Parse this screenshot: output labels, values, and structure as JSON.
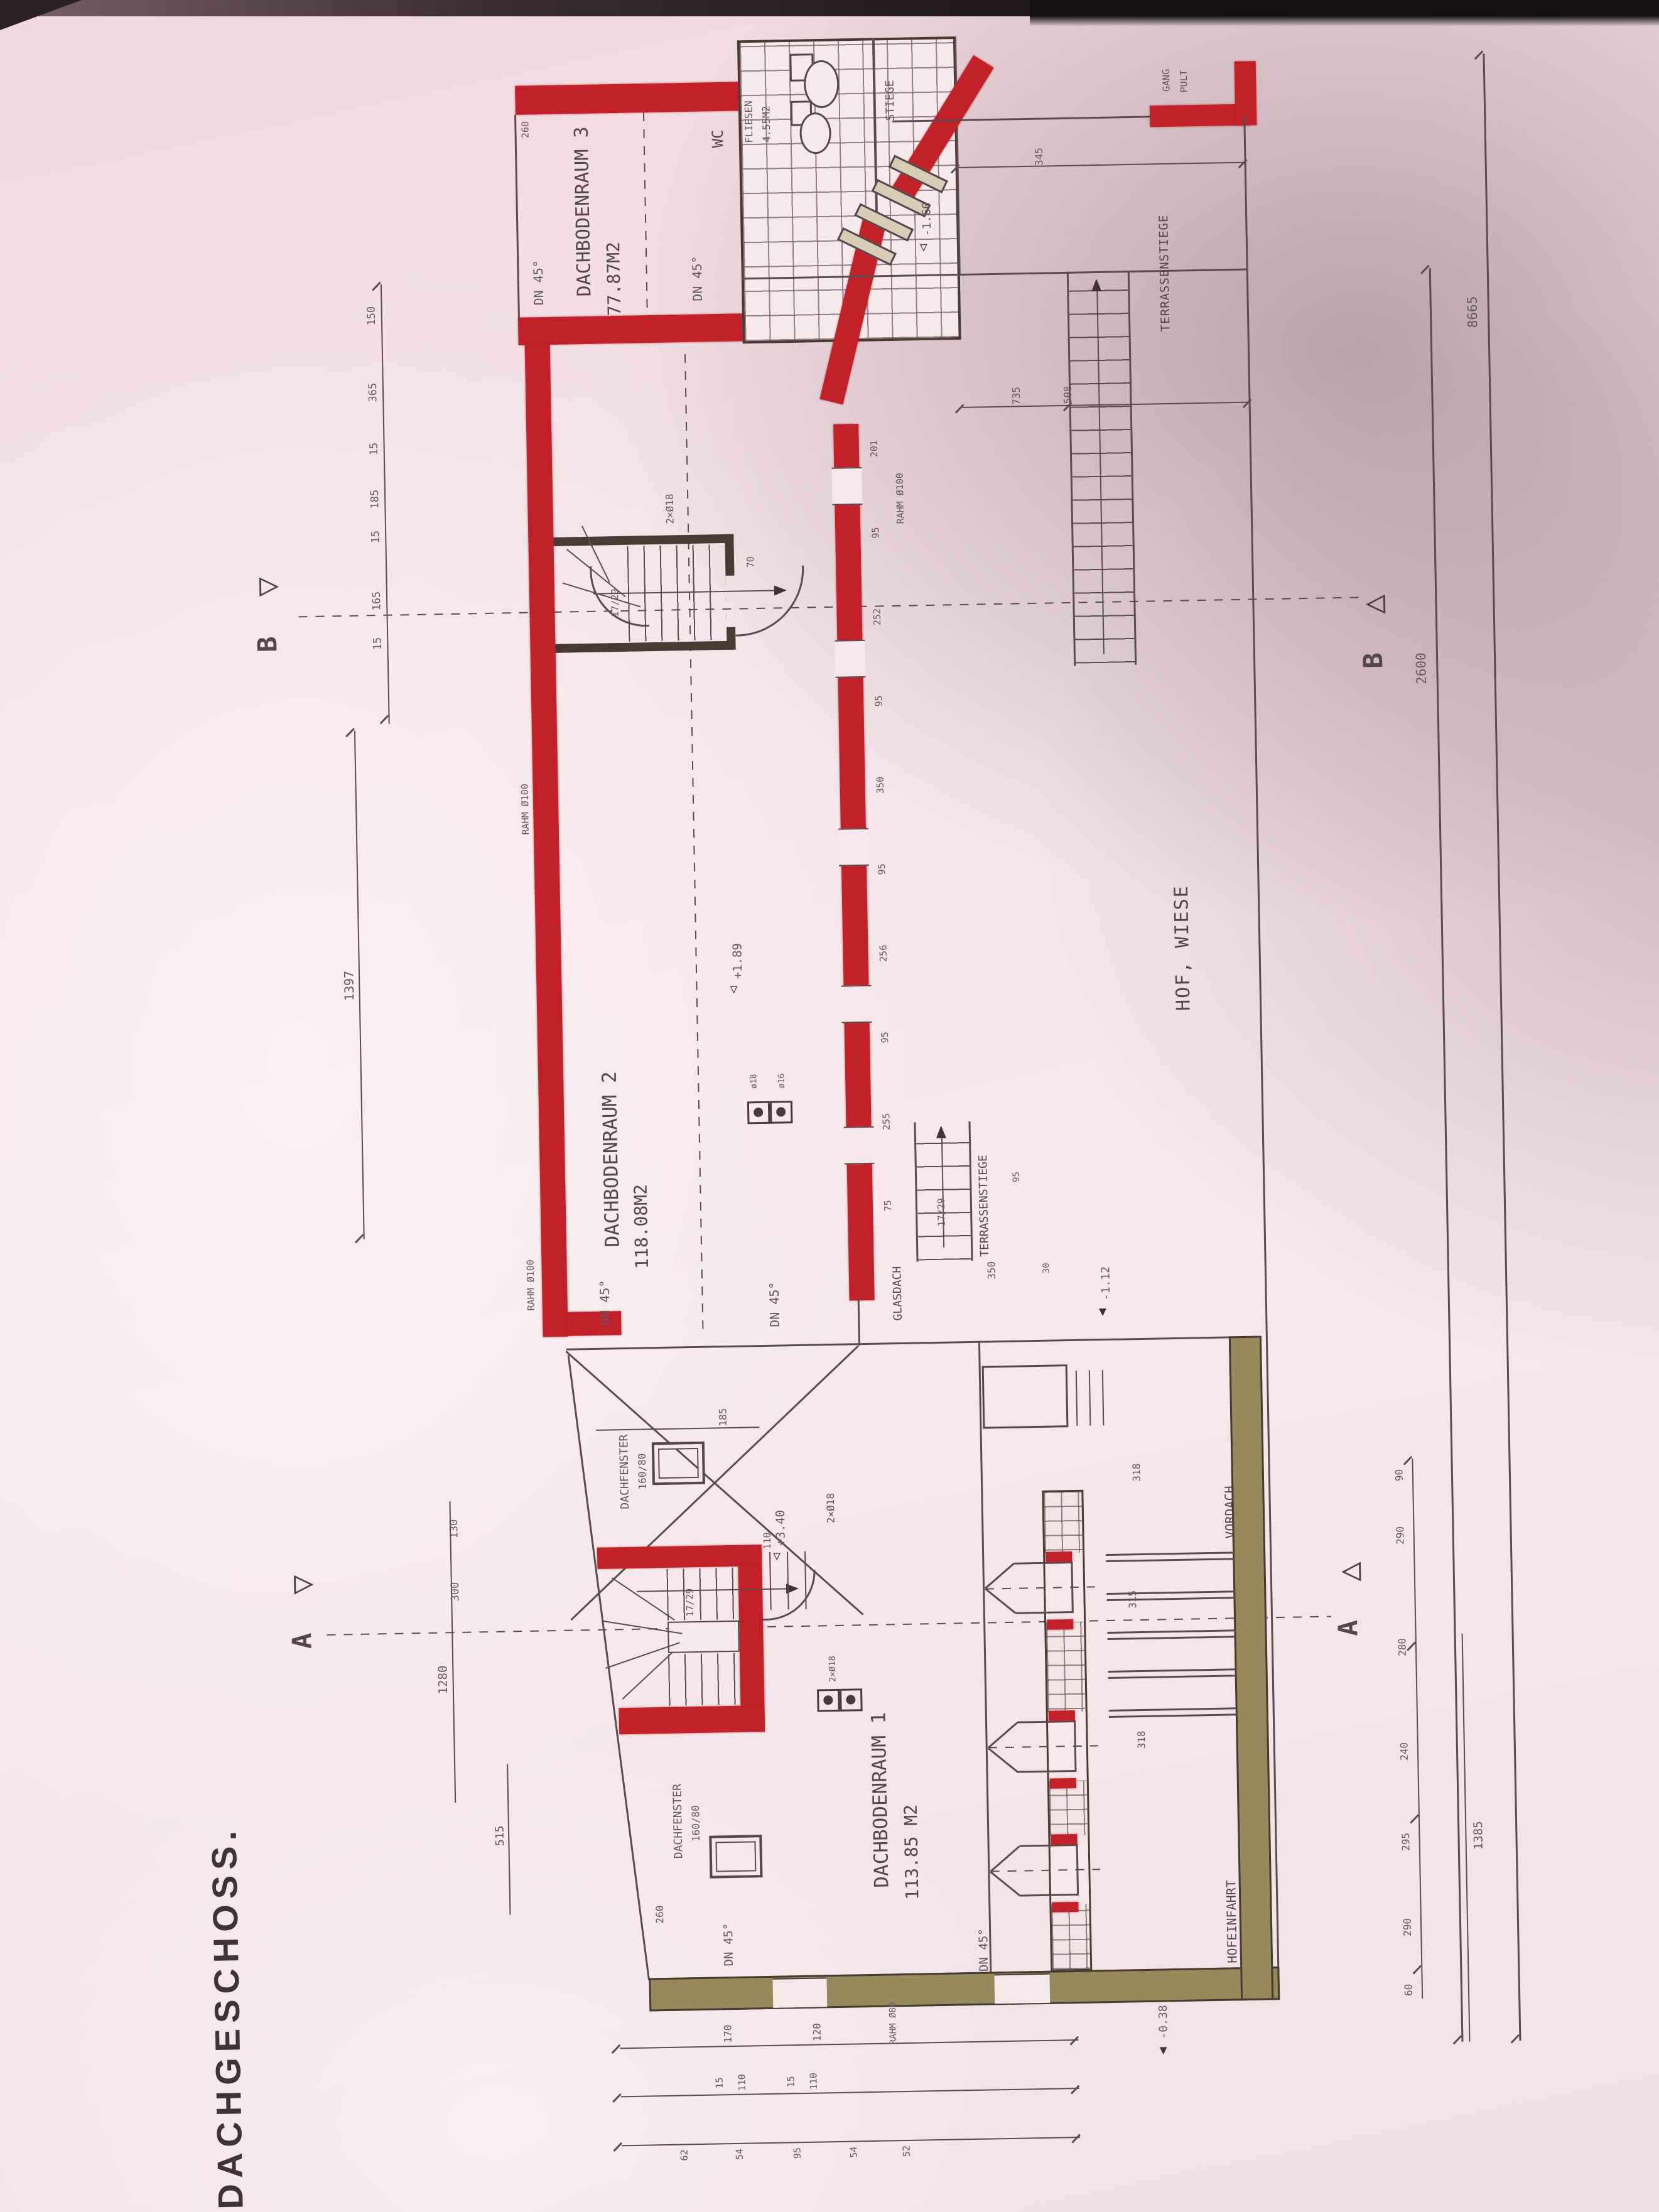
{
  "title": "DACHGESCHOSS.",
  "rooms": {
    "r3": {
      "name": "DACHBODENRAUM 3",
      "area": "77.87M2"
    },
    "r2": {
      "name": "DACHBODENRAUM 2",
      "area": "118.08M2"
    },
    "r1": {
      "name": "DACHBODENRAUM 1",
      "area": "113.85 M2"
    },
    "wc": {
      "name": "WC",
      "finish": "FLIESEN",
      "area": "4.55M2"
    }
  },
  "site": {
    "hof": "HOF, WIESE",
    "hofeinfahrt": "HOFEINFAHRT",
    "vordach": "VORDACH",
    "glasdach": "GLASDACH",
    "terrassenstiege": "TERRASSENSTIEGE",
    "stiege": "STIEGE",
    "gang": "GANG",
    "pult": "PULT"
  },
  "notes": {
    "dn45": "DN 45°",
    "rahm100": "RAHM Ø100",
    "rahm80": "RAHM Ø80",
    "dachfenster": "DACHFENSTER",
    "fsize": "160/80",
    "ratio": "17/29",
    "flue": "2×Ø18",
    "d18": "ø18",
    "d16": "ø16"
  },
  "levels": {
    "l189": "+1.89",
    "l340": "+3.40",
    "l160": "-1.60",
    "l112": "-1.12",
    "l038": "-0.38"
  },
  "sections": {
    "a": "A",
    "b": "B"
  },
  "dims": {
    "right_total": "8665",
    "right_inner": "2600",
    "r1385": "1385",
    "right_chain": [
      "90",
      "290",
      "280",
      "240",
      "295",
      "290",
      "60"
    ],
    "left_chain": [
      "150",
      "365",
      "15",
      "185",
      "15",
      "165",
      "15"
    ],
    "l1397": "1397",
    "left_lower": [
      "130",
      "300",
      "1280",
      "515"
    ],
    "top_chain": [
      "345",
      "735",
      "508"
    ],
    "wall_chain": [
      "201",
      "95",
      "252",
      "95",
      "350",
      "95",
      "256",
      "95",
      "255",
      "75"
    ],
    "bottom_r1": [
      "170",
      "120"
    ],
    "bottom_r2": [
      "15",
      "110",
      "15",
      "110"
    ],
    "bottom_r3": [
      "62",
      "54",
      "95",
      "54",
      "52"
    ],
    "misc": {
      "d70": "70",
      "d185": "185",
      "d260a": "260",
      "d260b": "260",
      "d350": "350",
      "d30": "30",
      "d95": "95",
      "d315": "315",
      "d318a": "318",
      "d318b": "318",
      "d110": "110"
    }
  }
}
